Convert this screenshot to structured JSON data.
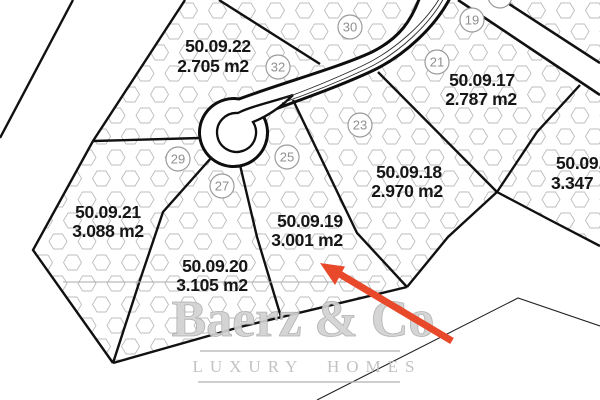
{
  "plots": [
    {
      "id": "50.09.22",
      "area": "2.705 m2"
    },
    {
      "id": "50.09.17",
      "area": "2.787 m2"
    },
    {
      "id": "50.09.18",
      "area": "2.970 m2"
    },
    {
      "id": "50.09.19",
      "area": "3.001 m2"
    },
    {
      "id": "50.09.20",
      "area": "3.105 m2"
    },
    {
      "id": "50.09.21",
      "area": "3.088 m2"
    },
    {
      "id": "50.09.",
      "area": "3.347"
    }
  ],
  "markers": [
    "30",
    "32",
    "21",
    "19",
    "23",
    "25",
    "27",
    "29"
  ],
  "watermark": {
    "name": "Baerz & Co",
    "tagline": "LUXURY HOMES"
  },
  "colors": {
    "arrow_red": "#e8492b",
    "boundary_black": "#111111",
    "hatch_gray": "#bcbcbc",
    "marker_gray": "#9a9a9a",
    "watermark_gray": "#cccccc"
  }
}
